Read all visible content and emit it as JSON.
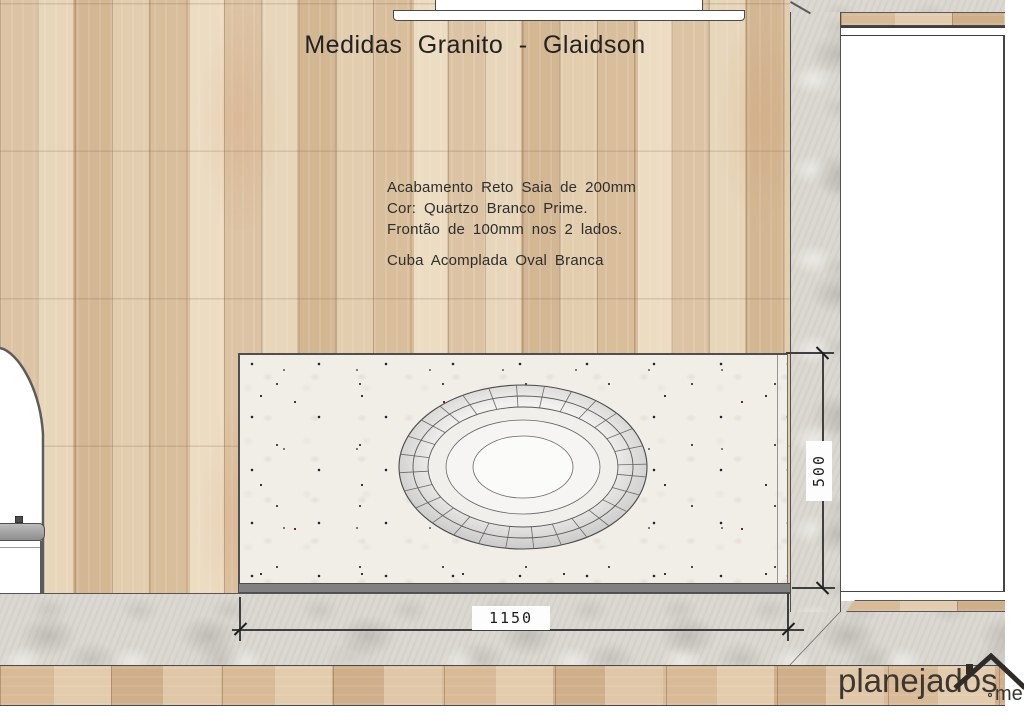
{
  "title": "Medidas Granito - Glaidson",
  "notes": {
    "finish": "Acabamento Reto Saia de 200mm",
    "color": "Cor: Quartzo Branco Prime.",
    "front": "Frontão de 100mm nos 2 lados.",
    "sink": "Cuba Acomplada Oval Branca"
  },
  "dimensions": {
    "counter_width_mm": "1150",
    "counter_depth_mm": "500"
  },
  "logo": {
    "brand": "planejados",
    "tld": "me"
  },
  "colors": {
    "wood": "#dcc4a5",
    "stone": "#dad8d1",
    "granite": "#f1eee8",
    "skirt": "#818181",
    "dimension_line": "#3f3f3f",
    "text": "#2b2b2b"
  }
}
